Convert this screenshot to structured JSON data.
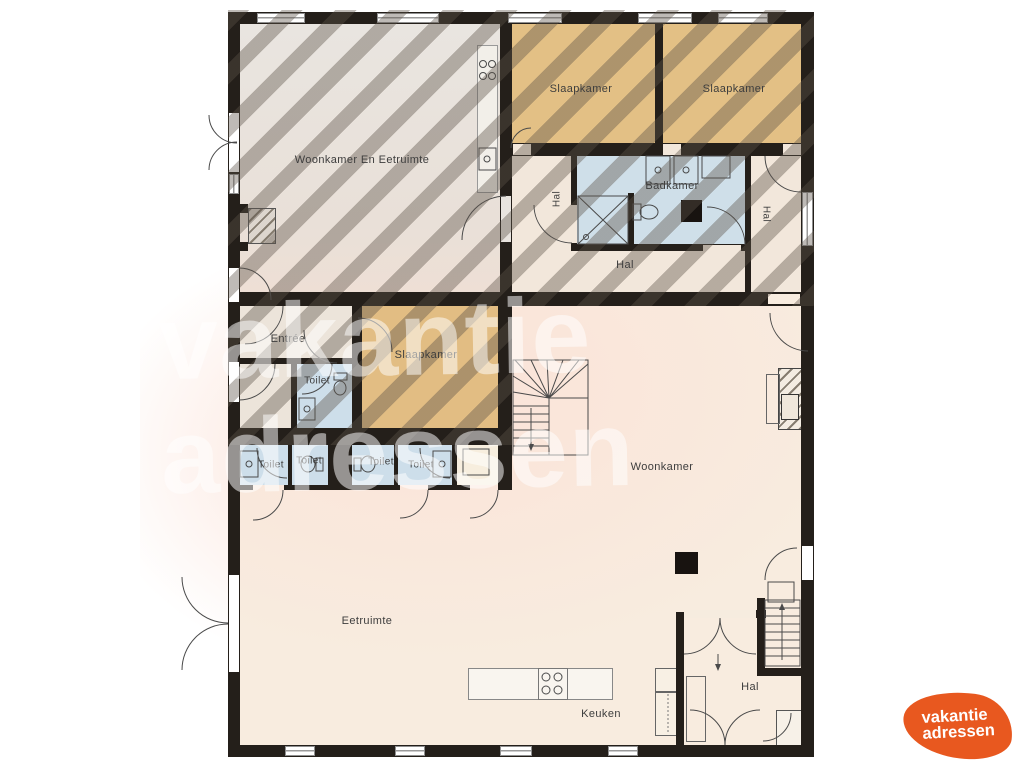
{
  "labels": {
    "living_dining": "Woonkamer En Eetruimte",
    "bedroom_top_left": "Slaapkamer",
    "bedroom_top_right": "Slaapkamer",
    "bathroom": "Badkamer",
    "hall_upper_left_vertical": "Hal",
    "hall_upper_right_vertical": "Hal",
    "hall_upper": "Hal",
    "entree": "Entrée",
    "bedroom_mid": "Slaapkamer",
    "toilet_mid": "Toilet",
    "toilet_1": "Toilet",
    "toilet_2": "Toilet",
    "toilet_3": "Toilet",
    "toilet_4": "Toilet",
    "living": "Woonkamer",
    "dining": "Eetruimte",
    "kitchen": "Keuken",
    "hall_lower": "Hal"
  },
  "watermark": {
    "line1": "vakantie",
    "line2": "adressen"
  },
  "logo": {
    "line1": "vakantie",
    "line2": "adressen"
  },
  "icons": {
    "stove": "four-burner-cooktop",
    "sink": "basin-with-tap",
    "toilet": "toilet-bowl",
    "shower": "crossed-square",
    "stairs": "treads-with-arrow",
    "fireplace": "hatched-square",
    "door": "quarter-circle-swing"
  },
  "colors": {
    "wall": "#241f1a",
    "ground_floor": "#f8ecdf",
    "upper_gray_room": "#e9e4de",
    "bedroom_tan": "#e3c085",
    "wet_room_blue": "#cddeea",
    "upper_hall_cream": "#f2e7db",
    "hatch_overlay": "rgba(92,82,72,0.40)",
    "logo_orange": "#e8581f",
    "watermark_white": "rgba(255,255,255,0.52)"
  }
}
